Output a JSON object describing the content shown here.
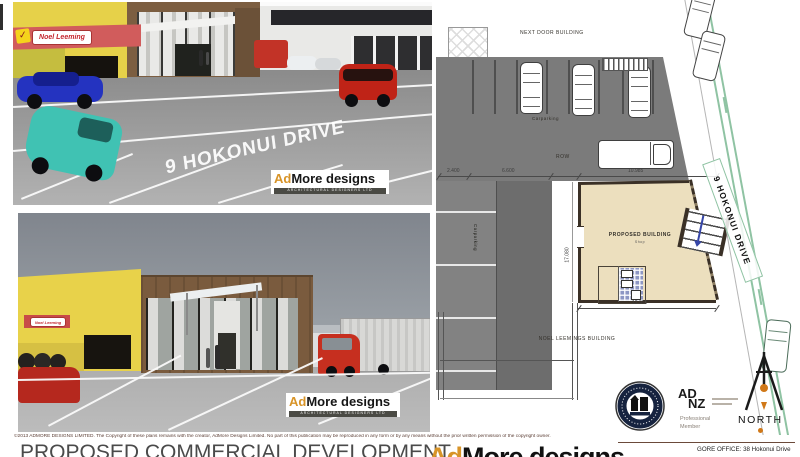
{
  "colors": {
    "noel_red": "#c84b48",
    "building_yellow": "#e6d149",
    "building_brown": "#7a5b3e",
    "plan_grey": "#7b7b7b",
    "plan_tan": "#ecdfbe",
    "kerb_green": "#8fc3a3",
    "logo_gold": "#d89428",
    "north_orange": "#d07818"
  },
  "signs": {
    "noel_leeming": "Noel Leeming"
  },
  "brand": {
    "ad": "Ad",
    "more": "More designs",
    "sub": "ARCHITECTURAL DESIGNERS LTD"
  },
  "render_top": {
    "road_text": "9 HOKONUI DRIVE"
  },
  "site_plan": {
    "labels": {
      "next_door": "NEXT DOOR BUILDING",
      "carparking_small": "Carparking",
      "row": "ROW",
      "carparking_vertical": "Carparking",
      "proposed_building": "PROPOSED BUILDING",
      "proposed_building_sub": "Shop",
      "noel_leemings": "NOEL LEEMINGS BUILDING",
      "road": "9 HOKONUI DRIVE",
      "north": "NORTH"
    },
    "dimensions": {
      "d2400": "2.400",
      "d6600": "6.600",
      "d10985": "10.985",
      "d12920": "12.920",
      "d17080": "17.080"
    }
  },
  "logos": {
    "adnz": {
      "ad": "AD",
      "nz": "NZ",
      "professional": "Professional",
      "member": "Member"
    }
  },
  "footer": {
    "copyright": "©2013 ADMORE DESIGNS LIMITED.  The Copyright of these plans remains with the creator, AdMore Designs Limited.   No part of this publication may be reproduced in any form or by any means without the prior written permission of the copyright owner.",
    "title": "PROPOSED COMMERCIAL DEVELOPMENT",
    "office": "GORE OFFICE: 38 Hokonui Drive"
  }
}
